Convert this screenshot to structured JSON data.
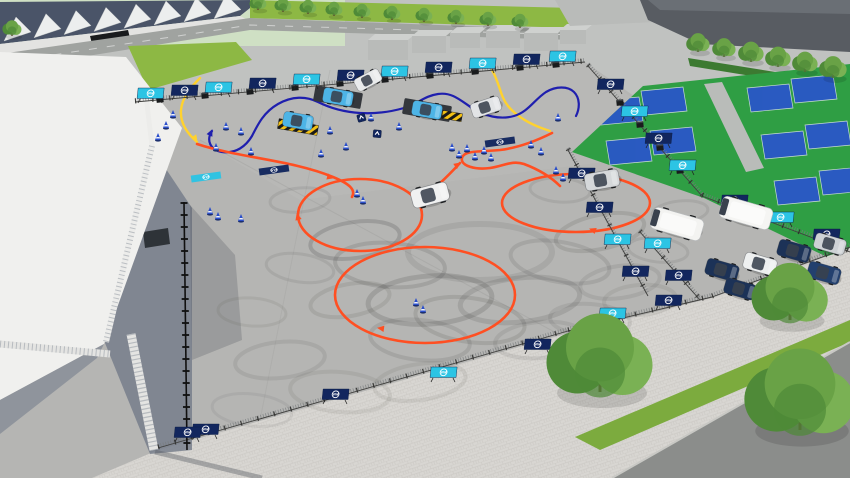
{
  "scene": {
    "brand_logo_text": "VW",
    "description": "3D aerial render of a fenced Volkswagen driving-experience event area: slalom course with blue cars and ramps, orange drift figure-eight with skid marks, drift circle, VW-branded barriers, vans and parked cars, event tent with trusses, stadium, buildings, tennis courts, trees and roads."
  },
  "colors": {
    "bg": "#c0c2c0",
    "pad": "#b5b5b3",
    "plaza": "#d8d6d2",
    "roadTop": "#a0a3a0",
    "roadAsphalt": "#8b8d8b",
    "grassBright": "#8db844",
    "grassStrip": "#7cab3e",
    "tennisGreen": "#2f9e44",
    "tennisBlue": "#2a57c8",
    "hedge": "#3c7a31",
    "walkway": "#b9bcb9",
    "stadiumBackdrop": "#cfe0c4",
    "stadiumGlass": "#4a5468",
    "stadiumWall": "#e3e3e1",
    "stadiumFin": "#eceeee",
    "buildGray": "#b9bbb9",
    "buildTop": "#cfd1cf",
    "buildDark": "#585c62",
    "buildDarkTop": "#6a6f75",
    "tentRoof": "#f0f0ee",
    "tentWall": "#8f949c",
    "shadow": "#737a88",
    "bannerNavy": "#12265e",
    "bannerCyan": "#2cc4e4",
    "lineBlue": "#1f1fae",
    "lineYellow": "#ffd22e",
    "lineOrange": "#ff4f22",
    "cone": "#2a4eca",
    "skid": "#3e3e3c",
    "fence": "#3f3f3d",
    "block": "#191b1d",
    "treeTop": "#69a246",
    "treeMid": "#7ab154",
    "treeDark": "#4f8a38",
    "trunk": "#6d5138",
    "carBlue": "#4db4e6",
    "glass": "#39414d",
    "logoWhite": "#ffffff"
  },
  "stadium": {
    "fin_count": 8
  },
  "buildings": [
    [
      368,
      34,
      40,
      26
    ],
    [
      412,
      30,
      34,
      23
    ],
    [
      450,
      27,
      30,
      21
    ],
    [
      486,
      25,
      34,
      23
    ],
    [
      524,
      27,
      34,
      24
    ],
    [
      560,
      24,
      26,
      20
    ]
  ],
  "tennis_courts": [
    [
      618,
      112
    ],
    [
      662,
      102
    ],
    [
      627,
      152
    ],
    [
      671,
      142
    ],
    [
      768,
      99
    ],
    [
      812,
      90
    ],
    [
      782,
      146
    ],
    [
      826,
      136
    ],
    [
      795,
      192
    ],
    [
      840,
      182
    ]
  ],
  "fences": [
    [
      135,
      102,
      585,
      62,
      "std"
    ],
    [
      588,
      66,
      702,
      196,
      "std"
    ],
    [
      702,
      196,
      850,
      252,
      "std"
    ],
    [
      158,
      448,
      568,
      331,
      "std"
    ],
    [
      568,
      331,
      712,
      297,
      "std"
    ],
    [
      712,
      297,
      850,
      247,
      "std"
    ],
    [
      568,
      150,
      648,
      296,
      "std"
    ],
    [
      640,
      232,
      700,
      300,
      "std"
    ],
    [
      184,
      202,
      187,
      450,
      "heavy"
    ]
  ],
  "banners": [
    [
      150,
      99,
      "c"
    ],
    [
      184,
      96,
      "n"
    ],
    [
      218,
      93,
      "c"
    ],
    [
      262,
      89,
      "n"
    ],
    [
      306,
      85,
      "c"
    ],
    [
      350,
      81,
      "n"
    ],
    [
      394,
      77,
      "c"
    ],
    [
      438,
      73,
      "n"
    ],
    [
      482,
      69,
      "c"
    ],
    [
      526,
      65,
      "n"
    ],
    [
      562,
      62,
      "c"
    ],
    [
      610,
      90,
      "n"
    ],
    [
      634,
      117,
      "c"
    ],
    [
      658,
      144,
      "n"
    ],
    [
      682,
      171,
      "c"
    ],
    [
      734,
      206,
      "n"
    ],
    [
      780,
      223,
      "c"
    ],
    [
      826,
      240,
      "n"
    ],
    [
      205,
      435,
      "n"
    ],
    [
      335,
      400,
      "n"
    ],
    [
      443,
      378,
      "c"
    ],
    [
      537,
      350,
      "n"
    ],
    [
      612,
      319,
      "c"
    ],
    [
      668,
      306,
      "n"
    ],
    [
      187,
      438,
      "n"
    ],
    [
      581,
      179,
      "n"
    ],
    [
      599,
      213,
      "n"
    ],
    [
      617,
      245,
      "c"
    ],
    [
      635,
      277,
      "n"
    ],
    [
      657,
      249,
      "c"
    ],
    [
      678,
      281,
      "n"
    ]
  ],
  "ground_mats": [
    [
      206,
      177,
      "c"
    ],
    [
      274,
      170,
      "n"
    ],
    [
      500,
      142,
      "n"
    ]
  ],
  "blocks": [
    [
      160,
      100
    ],
    [
      205,
      96
    ],
    [
      250,
      92
    ],
    [
      295,
      88
    ],
    [
      340,
      84
    ],
    [
      385,
      80
    ],
    [
      430,
      76
    ],
    [
      475,
      72
    ],
    [
      520,
      68
    ],
    [
      556,
      65
    ],
    [
      602,
      82
    ],
    [
      620,
      103
    ],
    [
      640,
      125
    ],
    [
      660,
      148
    ],
    [
      680,
      171
    ]
  ],
  "platforms": [
    [
      338,
      97,
      48,
      16,
      10
    ],
    [
      427,
      110,
      48,
      16,
      10
    ]
  ],
  "ramps": [
    [
      298,
      127,
      40,
      10,
      10
    ],
    [
      452,
      116,
      20,
      8,
      10
    ]
  ],
  "cones": [
    [
      166,
      128
    ],
    [
      173,
      117
    ],
    [
      158,
      140
    ],
    [
      226,
      129
    ],
    [
      241,
      134
    ],
    [
      216,
      150
    ],
    [
      251,
      154
    ],
    [
      302,
      129
    ],
    [
      330,
      133
    ],
    [
      346,
      149
    ],
    [
      321,
      156
    ],
    [
      371,
      120
    ],
    [
      399,
      129
    ],
    [
      452,
      150
    ],
    [
      459,
      157
    ],
    [
      467,
      151
    ],
    [
      475,
      159
    ],
    [
      484,
      153
    ],
    [
      491,
      160
    ],
    [
      531,
      147
    ],
    [
      541,
      154
    ],
    [
      357,
      196
    ],
    [
      363,
      203
    ],
    [
      416,
      305
    ],
    [
      423,
      312
    ],
    [
      556,
      173
    ],
    [
      563,
      180
    ],
    [
      210,
      214
    ],
    [
      218,
      219
    ],
    [
      241,
      221
    ],
    [
      558,
      120
    ]
  ],
  "arrow_signs": [
    [
      362,
      120,
      -15
    ],
    [
      377,
      136,
      5
    ]
  ],
  "course_arrows": [
    [
      333,
      178,
      15,
      "o"
    ],
    [
      297,
      214,
      255,
      "o"
    ],
    [
      378,
      328,
      188,
      "o"
    ],
    [
      590,
      229,
      200,
      "o"
    ],
    [
      460,
      163,
      -35,
      "o"
    ],
    [
      212,
      130,
      -65,
      "b"
    ],
    [
      197,
      141,
      55,
      "y"
    ]
  ],
  "skids": [
    [
      355,
      240,
      45,
      18,
      -8,
      0.2,
      4
    ],
    [
      390,
      265,
      55,
      22,
      4,
      0.16,
      4
    ],
    [
      430,
      300,
      62,
      24,
      -4,
      0.18,
      5
    ],
    [
      470,
      320,
      55,
      22,
      8,
      0.14,
      4
    ],
    [
      520,
      300,
      60,
      22,
      -6,
      0.15,
      5
    ],
    [
      560,
      262,
      50,
      20,
      10,
      0.13,
      4
    ],
    [
      600,
      232,
      45,
      17,
      -12,
      0.14,
      4
    ],
    [
      480,
      252,
      72,
      28,
      0,
      0.11,
      6
    ],
    [
      420,
      340,
      50,
      20,
      6,
      0.13,
      4
    ],
    [
      350,
      300,
      40,
      16,
      -10,
      0.12,
      4
    ],
    [
      300,
      268,
      34,
      14,
      8,
      0.11,
      3
    ],
    [
      620,
      282,
      40,
      16,
      -8,
      0.11,
      4
    ],
    [
      658,
      250,
      30,
      12,
      6,
      0.1,
      3
    ],
    [
      540,
      340,
      45,
      18,
      -5,
      0.11,
      4
    ],
    [
      590,
      320,
      40,
      16,
      4,
      0.1,
      4
    ],
    [
      280,
      360,
      45,
      18,
      -6,
      0.1,
      4
    ],
    [
      340,
      392,
      50,
      20,
      5,
      0.09,
      4
    ],
    [
      420,
      382,
      46,
      18,
      -8,
      0.09,
      4
    ],
    [
      252,
      410,
      40,
      16,
      6,
      0.08,
      3
    ],
    [
      300,
      200,
      30,
      12,
      -5,
      0.11,
      3
    ],
    [
      252,
      312,
      34,
      14,
      4,
      0.09,
      3
    ],
    [
      680,
      212,
      28,
      11,
      -6,
      0.1,
      3
    ],
    [
      560,
      190,
      30,
      12,
      4,
      0.1,
      3
    ],
    [
      640,
      300,
      36,
      15,
      -4,
      0.09,
      4
    ]
  ],
  "vehicles": [
    {
      "t": "car",
      "x": 368,
      "y": 80,
      "r": -28,
      "s": 0.9,
      "c": "#e9ebec"
    },
    {
      "t": "car",
      "x": 338,
      "y": 97,
      "r": 10,
      "s": 1,
      "c": "#4db4e6"
    },
    {
      "t": "car",
      "x": 298,
      "y": 121,
      "r": 10,
      "s": 1,
      "c": "#4db4e6"
    },
    {
      "t": "car",
      "x": 427,
      "y": 110,
      "r": 10,
      "s": 1,
      "c": "#4db4e6"
    },
    {
      "t": "car",
      "x": 486,
      "y": 107,
      "r": -18,
      "s": 1,
      "c": "#e2e4e6"
    },
    {
      "t": "car",
      "x": 430,
      "y": 195,
      "r": -15,
      "s": 1.25,
      "c": "#f0f1f1"
    },
    {
      "t": "car",
      "x": 602,
      "y": 180,
      "r": -10,
      "s": 1.15,
      "c": "#d5d8da"
    },
    {
      "t": "van",
      "x": 677,
      "y": 224,
      "r": 16,
      "s": 1,
      "c": "#f3f3f1"
    },
    {
      "t": "van",
      "x": 746,
      "y": 213,
      "r": 16,
      "s": 1,
      "c": "#f5f5f3"
    },
    {
      "t": "car",
      "x": 722,
      "y": 270,
      "r": 16,
      "s": 1.1,
      "c": "#1c3257"
    },
    {
      "t": "car",
      "x": 760,
      "y": 264,
      "r": 16,
      "s": 1.1,
      "c": "#eef0f0"
    },
    {
      "t": "car",
      "x": 794,
      "y": 251,
      "r": 16,
      "s": 1.1,
      "c": "#1c3257"
    },
    {
      "t": "car",
      "x": 830,
      "y": 244,
      "r": 16,
      "s": 1.05,
      "c": "#ced2d5"
    },
    {
      "t": "car",
      "x": 824,
      "y": 273,
      "r": 16,
      "s": 1.1,
      "c": "#23406e"
    },
    {
      "t": "car",
      "x": 740,
      "y": 289,
      "r": 16,
      "s": 1.05,
      "c": "#1c3257"
    }
  ],
  "trees_small": [
    [
      258,
      8,
      8
    ],
    [
      283,
      10,
      8
    ],
    [
      308,
      12,
      8
    ],
    [
      334,
      14,
      8
    ],
    [
      362,
      16,
      8
    ],
    [
      392,
      18,
      8
    ],
    [
      424,
      20,
      8
    ],
    [
      456,
      22,
      8
    ],
    [
      488,
      24,
      8
    ],
    [
      520,
      26,
      8
    ],
    [
      698,
      50,
      11
    ],
    [
      724,
      55,
      11
    ],
    [
      751,
      60,
      12
    ],
    [
      778,
      65,
      12
    ],
    [
      805,
      70,
      12
    ],
    [
      833,
      76,
      13
    ],
    [
      12,
      34,
      9
    ]
  ],
  "trees_big": [
    [
      600,
      390,
      50
    ],
    [
      800,
      428,
      52
    ],
    [
      790,
      318,
      36
    ]
  ]
}
